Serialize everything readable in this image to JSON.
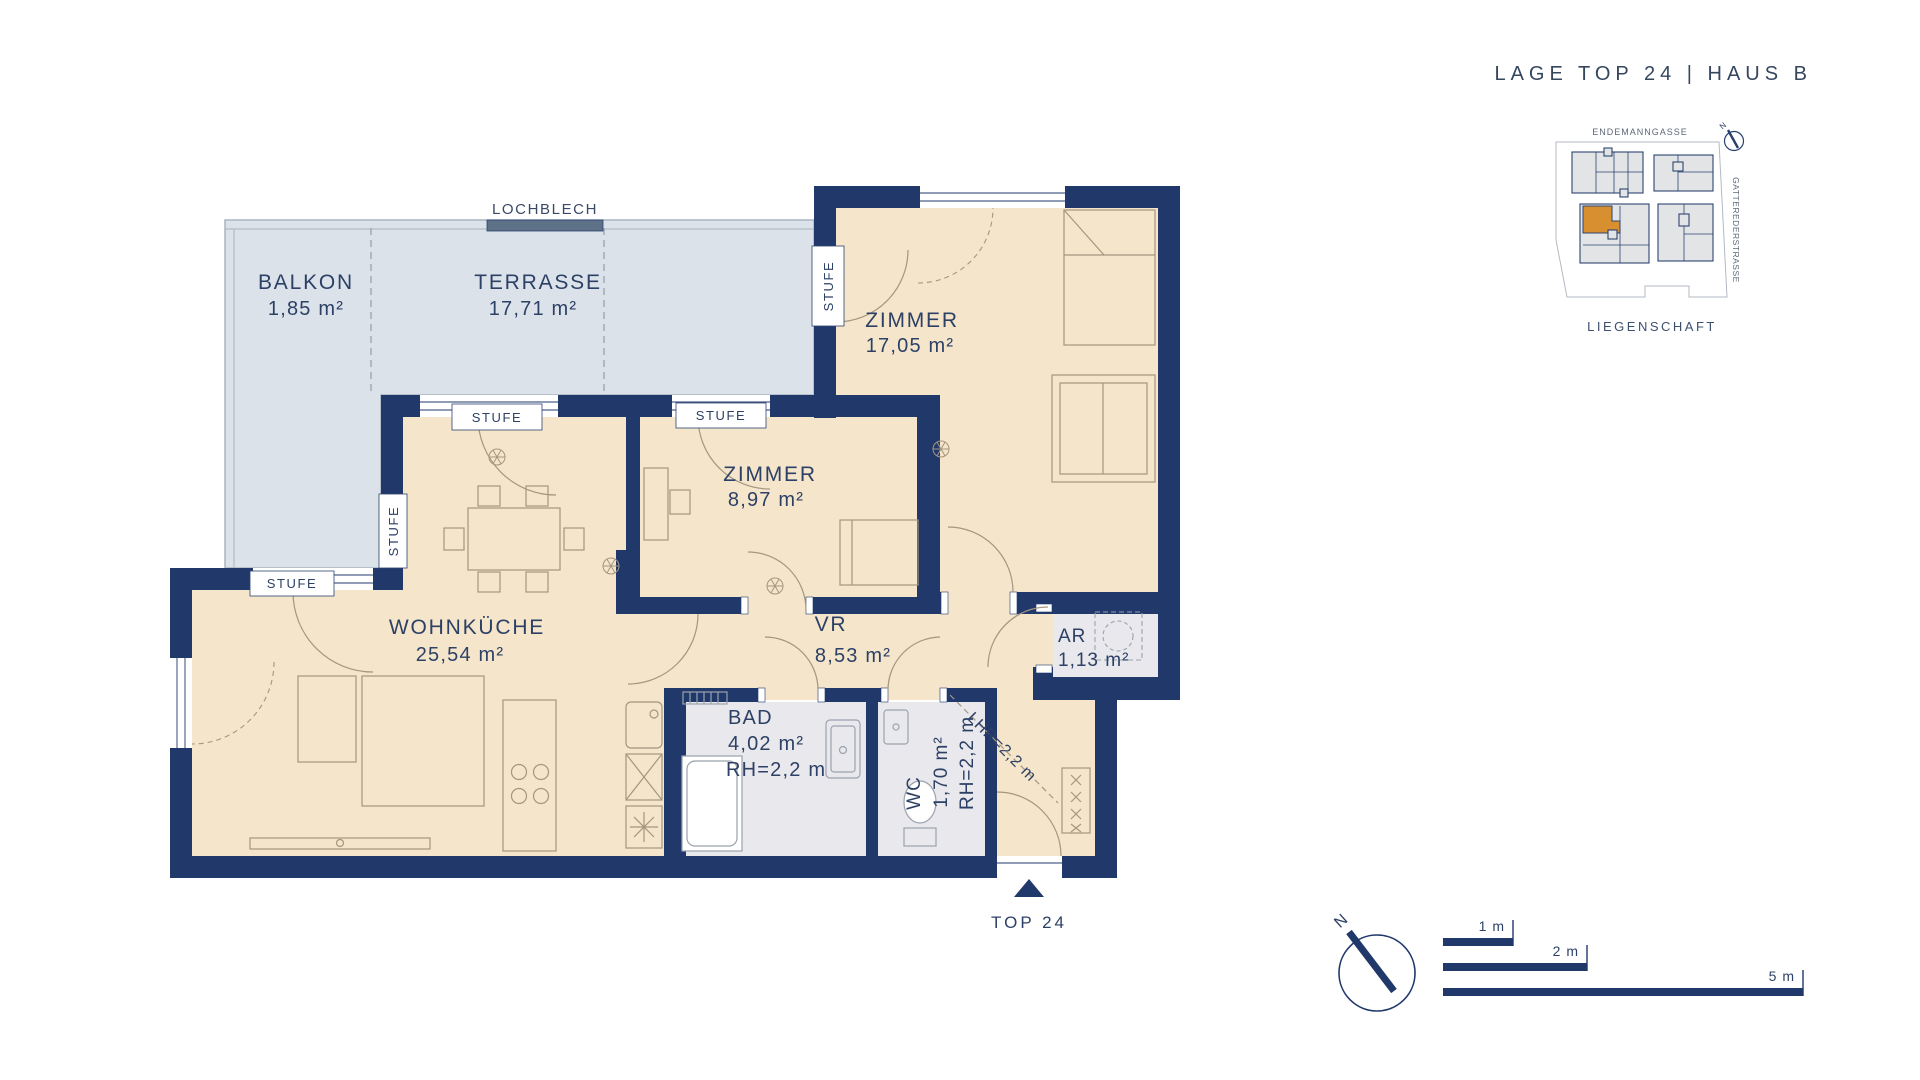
{
  "header": {
    "title": "LAGE TOP 24   |   HAUS B"
  },
  "site_plan": {
    "street_top": "ENDEMANNGASSE",
    "street_right": "GATTEREDERSTRASSE",
    "caption": "LIEGENSCHAFT",
    "north_label": "N",
    "highlight_color": "#d88f2f"
  },
  "labels": {
    "stufe": "STUFE",
    "lochblech": "LOCHBLECH",
    "lhr": "LHR=2,2 m",
    "entrance": "TOP 24"
  },
  "rooms": {
    "balkon": {
      "name": "BALKON",
      "area": "1,85 m²"
    },
    "terrasse": {
      "name": "TERRASSE",
      "area": "17,71 m²"
    },
    "zimmer_gross": {
      "name": "ZIMMER",
      "area": "17,05 m²"
    },
    "zimmer_klein": {
      "name": "ZIMMER",
      "area": "8,97 m²"
    },
    "wohnkueche": {
      "name": "WOHNKÜCHE",
      "area": "25,54 m²"
    },
    "vr": {
      "name": "VR",
      "area": "8,53 m²"
    },
    "bad": {
      "name": "BAD",
      "area": "4,02 m²",
      "rh": "RH=2,2 m"
    },
    "wc": {
      "name": "WC",
      "area": "1,70 m²",
      "rh": "RH=2,2 m"
    },
    "ar": {
      "name": "AR",
      "area": "1,13 m²"
    }
  },
  "compass": {
    "north": "N"
  },
  "scale_bar": {
    "bar1": "1 m",
    "bar2": "2 m",
    "bar3": "5 m"
  },
  "colors": {
    "wall": "#21386b",
    "floor": "#f4e5cb",
    "outdoor": "#dbe2e9",
    "wet_room": "#e9e8ec",
    "accent": "#d88f2f"
  }
}
